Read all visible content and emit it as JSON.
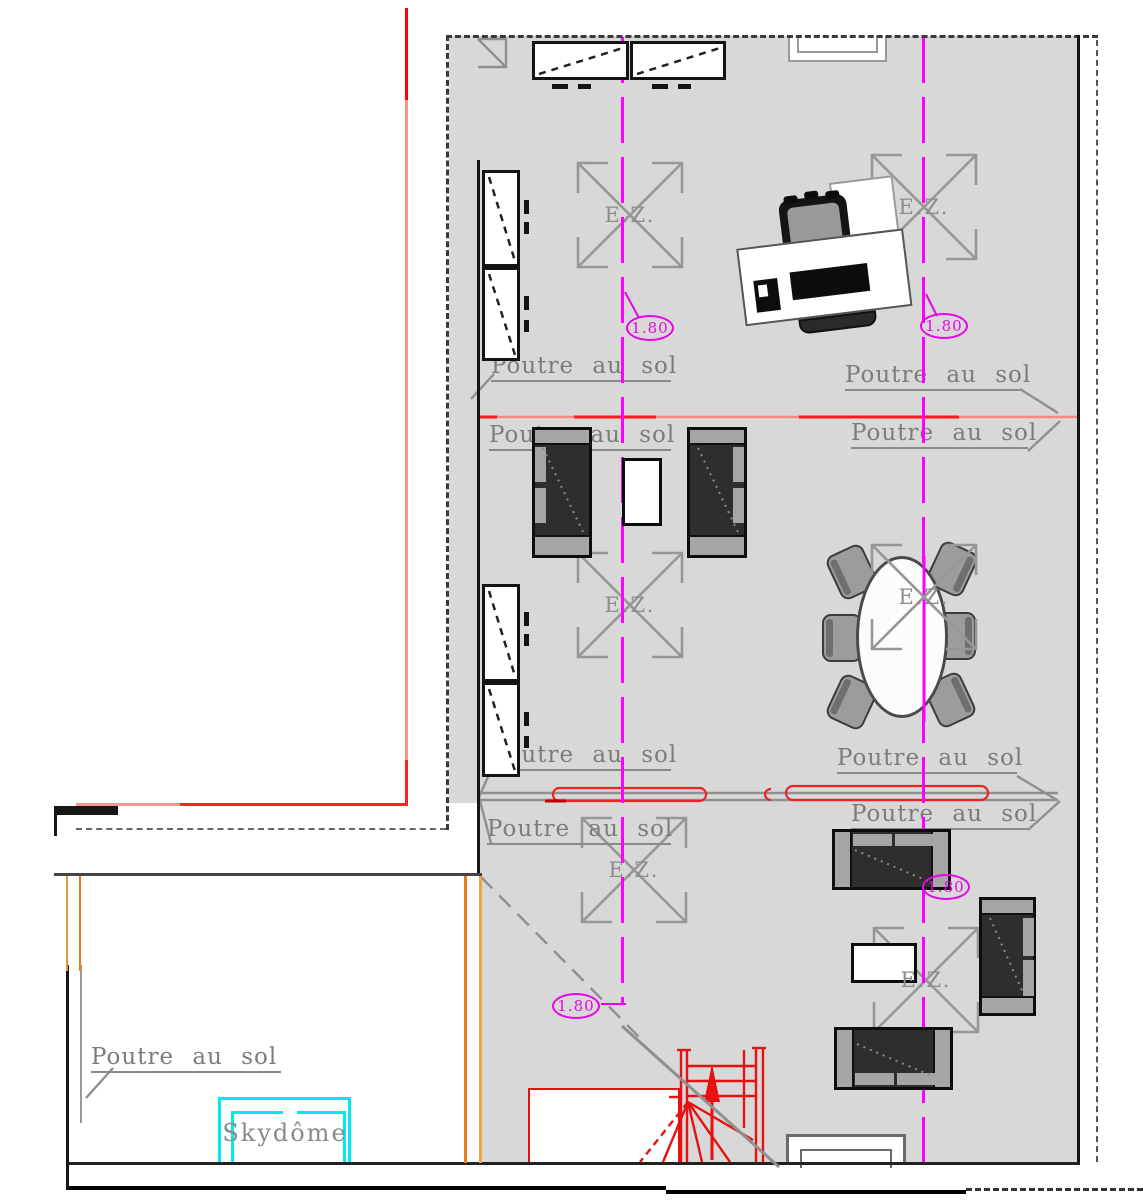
{
  "document": {
    "type": "architectural-floor-plan",
    "language": "French"
  },
  "labels": {
    "beam_label": "Poutre au sol",
    "skydome_label": "Skydôme",
    "zone_label": "E.Z.",
    "dimension_value": "1.80"
  },
  "beam_labels": [
    {
      "text": "Poutre au sol",
      "x": 491,
      "y": 353,
      "w": 180
    },
    {
      "text": "Poutre au sol",
      "x": 845,
      "y": 362,
      "w": 175
    },
    {
      "text": "Poutre au sol",
      "x": 489,
      "y": 422,
      "w": 182
    },
    {
      "text": "Poutre au sol",
      "x": 851,
      "y": 420,
      "w": 177
    },
    {
      "text": "Poutre au sol",
      "x": 491,
      "y": 742,
      "w": 180
    },
    {
      "text": "Poutre au sol",
      "x": 837,
      "y": 745,
      "w": 180
    },
    {
      "text": "Poutre au sol",
      "x": 851,
      "y": 801,
      "w": 177
    },
    {
      "text": "Poutre au sol",
      "x": 487,
      "y": 816,
      "w": 184
    },
    {
      "text": "Poutre au sol",
      "x": 91,
      "y": 1044,
      "w": 190
    }
  ],
  "ez_markers": [
    {
      "x": 578,
      "y": 163,
      "size": 104
    },
    {
      "x": 872,
      "y": 155,
      "size": 104
    },
    {
      "x": 578,
      "y": 553,
      "size": 104
    },
    {
      "x": 872,
      "y": 545,
      "size": 104,
      "layer": "over"
    },
    {
      "x": 582,
      "y": 818,
      "size": 104
    },
    {
      "x": 874,
      "y": 928,
      "size": 104
    }
  ],
  "dimensions": [
    {
      "value": "1.80",
      "cx": 650,
      "cy": 328
    },
    {
      "value": "1.80",
      "cx": 944,
      "cy": 326
    },
    {
      "value": "1.80",
      "cx": 576,
      "cy": 1006
    },
    {
      "value": "1.80",
      "cx": 946,
      "cy": 887
    }
  ],
  "axes": [
    {
      "x": 621,
      "y1": 37,
      "y2": 1004
    },
    {
      "x": 922,
      "y1": 37,
      "y2": 1163
    }
  ],
  "icons": [
    "wardrobe-cabinet-icon",
    "desk-icon",
    "office-chair-icon",
    "monitor-icon",
    "keyboard-icon",
    "armchair-icon",
    "sofa-icon",
    "coffee-table-icon",
    "oval-table-icon",
    "dining-chair-icon",
    "stairs-icon",
    "skydome-icon",
    "window-niche-icon"
  ],
  "colors": {
    "floor_gray": "#d8d8d8",
    "axis_magenta": "#ff00ff",
    "dimension_magenta": "#e606e6",
    "beam_text_gray": "#7c7c7c",
    "red_line": "#ff1a1a",
    "salmon_line": "#f28b82",
    "orange_line": "#e87d1e",
    "skydome_cyan": "#00e8f0",
    "wall_black": "#161616",
    "furniture_dark": "#2e2e2e",
    "furniture_gray": "#a5a5a5"
  }
}
